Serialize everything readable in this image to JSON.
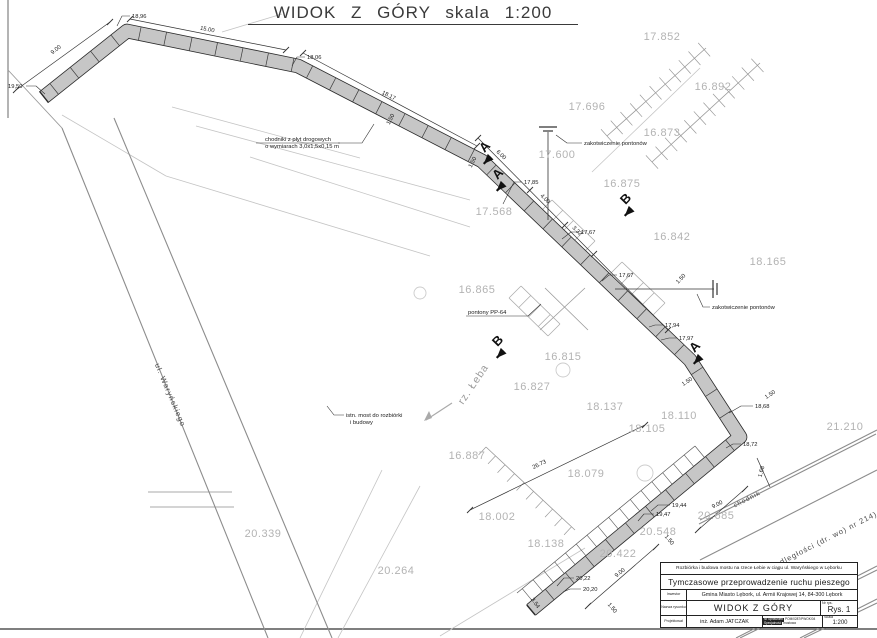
{
  "title": "WIDOK Z GÓRY skala 1:200",
  "streets": [
    {
      "v": "ul. Waryńskiego",
      "x": 168,
      "y": 396,
      "r": 67,
      "s": 7.5,
      "c": "#4a4a4a",
      "name": "street-label-warynskiego"
    },
    {
      "v": "rz. Łeba",
      "x": 476,
      "y": 386,
      "r": -56,
      "s": 10.5,
      "c": "#9a9a9a",
      "name": "river-label"
    },
    {
      "v": "Al. Niepodległości (dr. wo) nr 214)",
      "x": 812,
      "y": 549,
      "r": -27,
      "s": 7.5,
      "c": "#4a4a4a",
      "name": "street-label-niepodleglosci"
    },
    {
      "v": "chodnik",
      "x": 748,
      "y": 501,
      "r": -27,
      "s": 6.5,
      "c": "#4a4a4a",
      "name": "sidewalk-label"
    }
  ],
  "terrain": [
    {
      "v": "17.852",
      "x": 662,
      "y": 40
    },
    {
      "v": "16.892",
      "x": 713,
      "y": 90
    },
    {
      "v": "17.696",
      "x": 587,
      "y": 110
    },
    {
      "v": "16.873",
      "x": 662,
      "y": 136
    },
    {
      "v": "17.600",
      "x": 557,
      "y": 158
    },
    {
      "v": "16.875",
      "x": 622,
      "y": 187
    },
    {
      "v": "17.568",
      "x": 494,
      "y": 215
    },
    {
      "v": "16.842",
      "x": 672,
      "y": 240
    },
    {
      "v": "18.165",
      "x": 768,
      "y": 265
    },
    {
      "v": "16.865",
      "x": 477,
      "y": 293
    },
    {
      "v": "16.815",
      "x": 563,
      "y": 360
    },
    {
      "v": "16.827",
      "x": 532,
      "y": 390
    },
    {
      "v": "18.137",
      "x": 605,
      "y": 410
    },
    {
      "v": "18.110",
      "x": 679,
      "y": 419
    },
    {
      "v": "18.105",
      "x": 647,
      "y": 432
    },
    {
      "v": "21.210",
      "x": 845,
      "y": 430
    },
    {
      "v": "18.079",
      "x": 586,
      "y": 477
    },
    {
      "v": "16.887",
      "x": 467,
      "y": 459
    },
    {
      "v": "18.002",
      "x": 497,
      "y": 520
    },
    {
      "v": "20.339",
      "x": 263,
      "y": 537
    },
    {
      "v": "20.264",
      "x": 396,
      "y": 574
    },
    {
      "v": "18.138",
      "x": 546,
      "y": 547
    },
    {
      "v": "20.548",
      "x": 658,
      "y": 535
    },
    {
      "v": "20.422",
      "x": 618,
      "y": 557
    },
    {
      "v": "20.685",
      "x": 716,
      "y": 519
    }
  ],
  "spots": [
    {
      "v": "18,96",
      "x": 132,
      "y": 18,
      "l": [
        [
          130,
          16
        ],
        [
          122,
          16
        ],
        [
          117,
          26
        ]
      ]
    },
    {
      "v": "19,50",
      "x": 8,
      "y": 88,
      "l": [
        [
          26,
          86
        ],
        [
          36,
          86
        ],
        [
          45,
          94
        ]
      ]
    },
    {
      "v": "18,06",
      "x": 307,
      "y": 59,
      "l": [
        [
          305,
          57
        ],
        [
          297,
          57
        ],
        [
          292,
          66
        ]
      ]
    },
    {
      "v": "17,85",
      "x": 524,
      "y": 184,
      "l": [
        [
          522,
          182
        ],
        [
          514,
          182
        ],
        [
          503,
          204
        ]
      ]
    },
    {
      "v": "17,67",
      "x": 581,
      "y": 234,
      "l": [
        [
          579,
          232
        ],
        [
          571,
          232
        ],
        [
          562,
          239
        ]
      ]
    },
    {
      "v": "17,67",
      "x": 619,
      "y": 277,
      "l": [
        [
          617,
          275
        ],
        [
          609,
          275
        ],
        [
          602,
          281
        ]
      ]
    },
    {
      "v": "17,94",
      "x": 665,
      "y": 327,
      "l": [
        [
          663,
          325
        ],
        [
          655,
          325
        ],
        [
          649,
          327
        ]
      ]
    },
    {
      "v": "17,97",
      "x": 679,
      "y": 340,
      "l": [
        [
          677,
          338
        ],
        [
          669,
          338
        ],
        [
          661,
          340
        ]
      ]
    },
    {
      "v": "18,68",
      "x": 755,
      "y": 408,
      "l": [
        [
          753,
          406
        ],
        [
          741,
          406
        ],
        [
          729,
          413
        ]
      ]
    },
    {
      "v": "18,72",
      "x": 743,
      "y": 446,
      "l": [
        [
          741,
          444
        ],
        [
          733,
          444
        ],
        [
          726,
          448
        ]
      ]
    },
    {
      "v": "19,44",
      "x": 672,
      "y": 507,
      "l": [
        [
          670,
          505
        ],
        [
          658,
          505
        ],
        [
          651,
          511
        ]
      ]
    },
    {
      "v": "19,47",
      "x": 656,
      "y": 516,
      "l": [
        [
          654,
          514
        ],
        [
          644,
          514
        ],
        [
          638,
          521
        ]
      ]
    },
    {
      "v": "20,22",
      "x": 576,
      "y": 580,
      "l": [
        [
          574,
          578
        ],
        [
          564,
          578
        ],
        [
          557,
          586
        ]
      ]
    },
    {
      "v": "20,20",
      "x": 583,
      "y": 591,
      "l": [
        [
          581,
          589
        ],
        [
          570,
          589
        ],
        [
          563,
          592
        ]
      ]
    }
  ],
  "dims": [
    {
      "v": "9.00",
      "x": 57,
      "y": 51,
      "r": -38
    },
    {
      "v": "15.00",
      "x": 207,
      "y": 31,
      "r": 11
    },
    {
      "v": "18.17",
      "x": 388,
      "y": 97,
      "r": 27
    },
    {
      "v": "6.00",
      "x": 500,
      "y": 156,
      "r": 44
    },
    {
      "v": "4.00",
      "x": 544,
      "y": 200,
      "r": 44
    },
    {
      "v": "3.32",
      "x": 576,
      "y": 232,
      "r": 44
    },
    {
      "v": "26.73",
      "x": 540,
      "y": 466,
      "r": -26
    },
    {
      "v": "9.00",
      "x": 621,
      "y": 574,
      "r": -40
    },
    {
      "v": "9.00",
      "x": 718,
      "y": 506,
      "r": -27
    },
    {
      "v": "1.68",
      "x": 763,
      "y": 472,
      "r": -75
    },
    {
      "v": "3.54",
      "x": 534,
      "y": 604,
      "r": 55
    },
    {
      "v": "1.50",
      "x": 392,
      "y": 120,
      "r": -63
    },
    {
      "v": "1.50",
      "x": 474,
      "y": 163,
      "r": -63
    },
    {
      "v": "1.50",
      "x": 682,
      "y": 280,
      "r": -46
    },
    {
      "v": "1.50",
      "x": 688,
      "y": 383,
      "r": -33
    },
    {
      "v": "1.50",
      "x": 771,
      "y": 396,
      "r": -33
    },
    {
      "v": "1.50",
      "x": 668,
      "y": 541,
      "r": 50
    },
    {
      "v": "1.50",
      "x": 611,
      "y": 609,
      "r": 50
    }
  ],
  "notes": [
    {
      "name": "note-slabs",
      "lines": [
        "chodniki z płyt drogowych",
        "o wymiarach 3,0x1,5x0,15 m"
      ],
      "x": 298,
      "y": 141,
      "anchor": "middle",
      "leader": [
        [
          338,
          143
        ],
        [
          362,
          143
        ],
        [
          374,
          124
        ]
      ],
      "underline": [
        256,
        143,
        340,
        143
      ]
    },
    {
      "name": "note-anchor-1",
      "lines": [
        "zakotwiczenie pontonów"
      ],
      "x": 584,
      "y": 145,
      "anchor": "start",
      "leader": [
        [
          582,
          143
        ],
        [
          567,
          143
        ],
        [
          556,
          135
        ]
      ]
    },
    {
      "name": "note-anchor-2",
      "lines": [
        "zakotwiczenie pontonów"
      ],
      "x": 712,
      "y": 309,
      "anchor": "start",
      "leader": [
        [
          710,
          307
        ],
        [
          703,
          307
        ],
        [
          697,
          294
        ]
      ]
    },
    {
      "name": "note-pontoons",
      "lines": [
        "pontony PP-64"
      ],
      "x": 468,
      "y": 314,
      "anchor": "start",
      "leader": [
        [
          511,
          316
        ],
        [
          528,
          316
        ],
        [
          541,
          304
        ]
      ],
      "underline": [
        466,
        316,
        511,
        316
      ]
    },
    {
      "name": "note-old-bridge",
      "lines": [
        "istn. most do rozbiórki",
        "i budowy"
      ],
      "x": 346,
      "y": 417,
      "anchor": "start",
      "leader": [
        [
          344,
          415
        ],
        [
          334,
          415
        ],
        [
          327,
          406
        ]
      ]
    }
  ],
  "markers": [
    {
      "v": "A",
      "x": 487,
      "y": 149,
      "r": -46,
      "d": -1
    },
    {
      "v": "A",
      "x": 500,
      "y": 176,
      "r": -46,
      "d": -1
    },
    {
      "v": "B",
      "x": 628,
      "y": 201,
      "r": -46,
      "d": -1
    },
    {
      "v": "B",
      "x": 500,
      "y": 343,
      "r": -46,
      "d": -1
    },
    {
      "v": "A",
      "x": 697,
      "y": 349,
      "r": -46,
      "d": -1
    }
  ],
  "title_block": {
    "project": "Rozbiórka i budowa mostu na rzece Łebie w ciągu ul. Waryńskiego w Lęborku",
    "subject": "Tymczasowe przeprowadzenie ruchu pieszego",
    "investor_label": "Inwestor",
    "investor": "Gmina Miasto Lębork, ul. Armii Krajowej 14, 84-300 Lębork",
    "drawing_label": "Nazwa rysunku",
    "drawing_title": "WIDOK Z GÓRY",
    "number_label": "Nr rys.",
    "number": "Rys. 1",
    "designer_label": "Projektował",
    "designer": "inż. Adam JATCZAK",
    "license_label": "Nr uprawnień",
    "license": "POM/0287/PWOK/04",
    "specialty_label": "Specjalność",
    "specialty": "mostowa",
    "scale_label": "Skala",
    "scale": "1:200"
  }
}
